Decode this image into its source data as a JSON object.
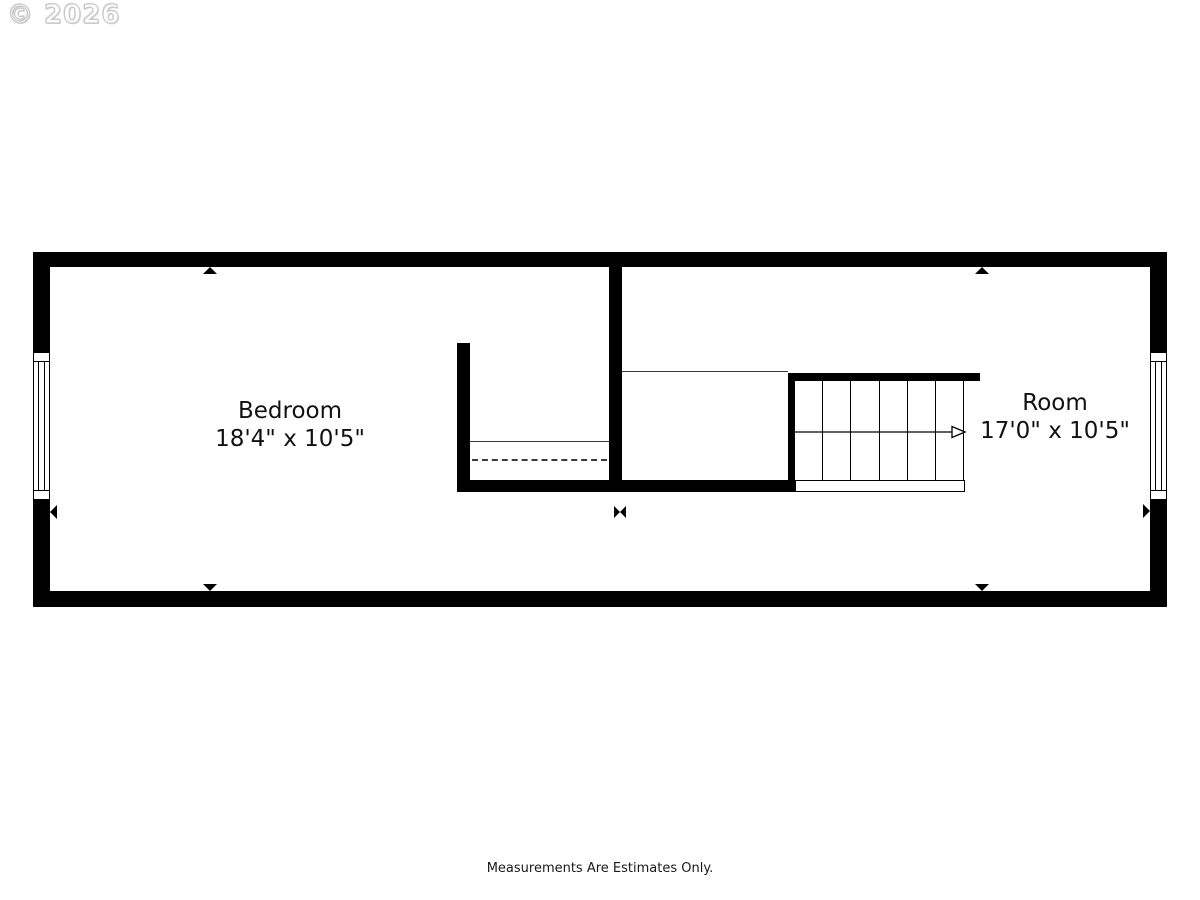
{
  "watermark": {
    "text": "© 2026"
  },
  "footer": {
    "disclaimer": "Measurements Are Estimates Only."
  },
  "floorplan": {
    "rooms": [
      {
        "name": "Bedroom",
        "dimensions": "18'4\" x 10'5\""
      },
      {
        "name": "Room",
        "dimensions": "17'0\" x 10'5\""
      }
    ],
    "stairs": {
      "tread_count": 6,
      "direction": "right"
    },
    "colors": {
      "wall": "#000000",
      "background": "#ffffff",
      "thin_line": "#3a3a3a",
      "watermark_outline": "#c8c8c8"
    }
  }
}
